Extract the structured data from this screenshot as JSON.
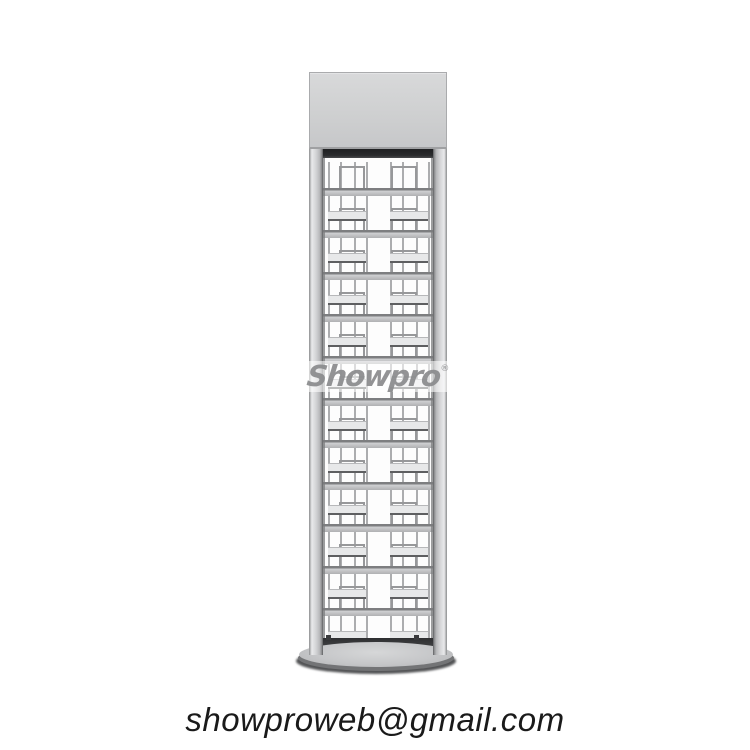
{
  "watermark": {
    "text": "Showpro",
    "registered_mark": "®"
  },
  "footer": {
    "email": "showproweb@gmail.com"
  },
  "rack": {
    "shelf_count": 11,
    "pockets_per_shelf": 2,
    "row_pitch_px": 42,
    "colors": {
      "header_light": "#d8d9da",
      "header_mid": "#cecfd0",
      "header_dark": "#c6c7c9",
      "header_border": "#aaabad",
      "post_edge": "#8c8d8f",
      "post_light": "#e9eaeb",
      "post_mid": "#d2d3d5",
      "recess": "#2a2b2d",
      "bar_top": "#7d7e80",
      "bar_light": "#cfd0d2",
      "bar_dark": "#b0b1b3",
      "wire": "#acadaf",
      "bracket": "#97989a",
      "tray_face": "#e7e8e9",
      "tray_edge": "#5e5f61",
      "bottom_strip": "#3e3f41",
      "base_top": "#c6c7c9",
      "base_rim": "#737476",
      "base_shadow": "#535456"
    }
  }
}
